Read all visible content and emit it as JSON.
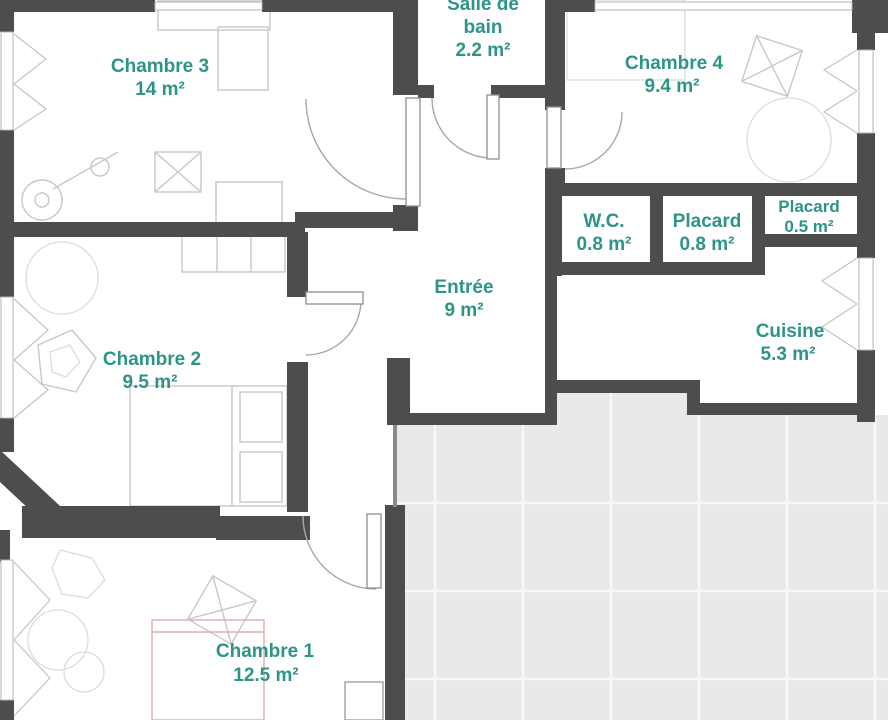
{
  "plan_title": "Apartment floor plan",
  "colors": {
    "wall": "#4d4d4d",
    "room_label": "#2e9488",
    "tile_floor": "#e9e9e9",
    "floor": "#ffffff"
  },
  "rooms": {
    "chambre3": {
      "name": "Chambre 3",
      "area": "14 m²"
    },
    "salle_de_bain": {
      "name_line1": "Salle de",
      "name_line2": "bain",
      "area": "2.2 m²"
    },
    "chambre4": {
      "name": "Chambre 4",
      "area": "9.4 m²"
    },
    "wc": {
      "name": "W.C.",
      "area": "0.8 m²"
    },
    "placard_grand": {
      "name": "Placard",
      "area": "0.8 m²"
    },
    "placard_petit": {
      "name": "Placard",
      "area": "0.5 m²"
    },
    "entree": {
      "name": "Entrée",
      "area": "9 m²"
    },
    "cuisine": {
      "name": "Cuisine",
      "area": "5.3 m²"
    },
    "chambre2": {
      "name": "Chambre 2",
      "area": "9.5 m²"
    },
    "chambre1": {
      "name": "Chambre 1",
      "area": "12.5 m²"
    }
  }
}
